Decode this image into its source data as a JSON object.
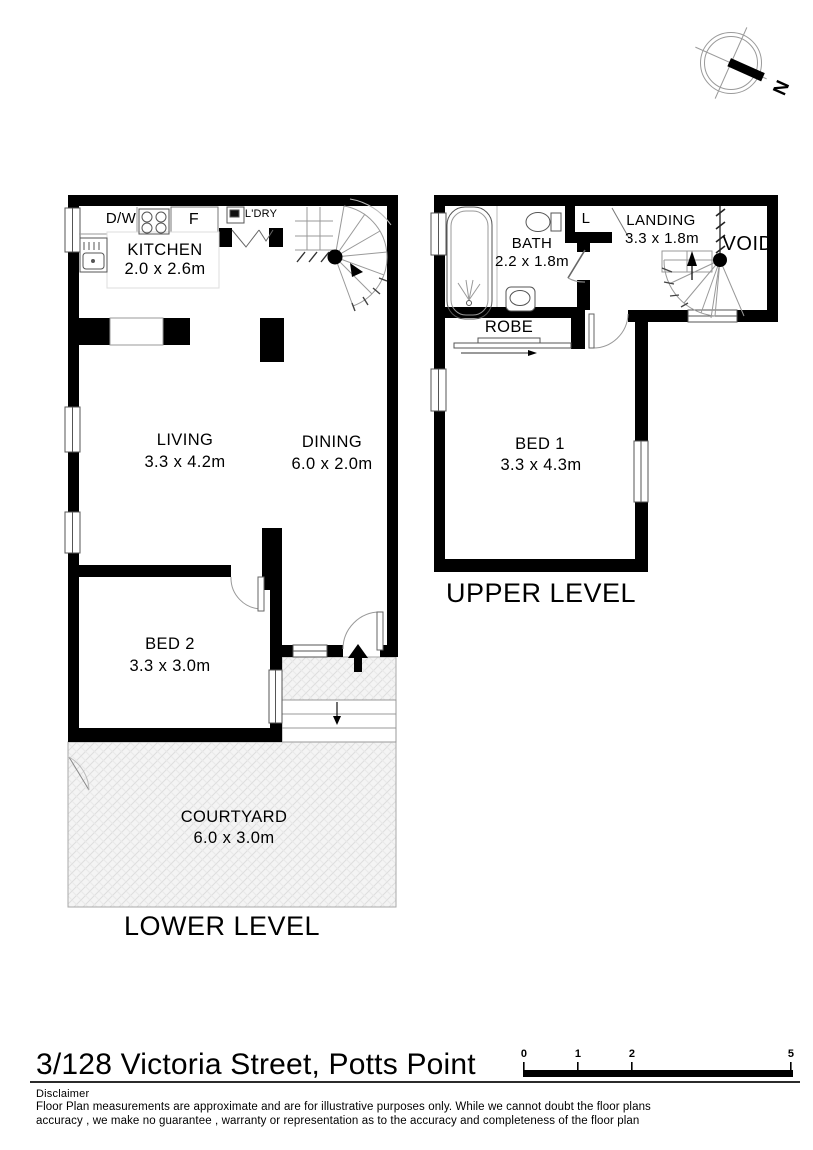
{
  "compass": {
    "north_label": "N"
  },
  "lower": {
    "title": "LOWER LEVEL",
    "rooms": [
      {
        "name": "KITCHEN",
        "dims": "2.0 x 2.6m"
      },
      {
        "name": "LIVING",
        "dims": "3.3 x 4.2m"
      },
      {
        "name": "DINING",
        "dims": "6.0 x 2.0m"
      },
      {
        "name": "BED 2",
        "dims": "3.3 x 3.0m"
      },
      {
        "name": "COURTYARD",
        "dims": "6.0 x 3.0m"
      }
    ],
    "labels": {
      "dishwasher": "D/W",
      "fridge": "F",
      "laundry": "L'DRY"
    }
  },
  "upper": {
    "title": "UPPER LEVEL",
    "rooms": [
      {
        "name": "BATH",
        "dims": "2.2 x 1.8m"
      },
      {
        "name": "LANDING",
        "dims": "3.3 x 1.8m"
      },
      {
        "name": "BED 1",
        "dims": "3.3 x 4.3m"
      }
    ],
    "labels": {
      "linen": "L",
      "void": "VOID",
      "robe": "ROBE"
    }
  },
  "footer": {
    "address": "3/128 Victoria Street, Potts Point",
    "disclaimer_title": "Disclaimer",
    "disclaimer_line1": "Floor Plan measurements are approximate and are for illustrative purposes only. While we cannot doubt the floor plans",
    "disclaimer_line2": "accuracy , we make no guarantee , warranty or representation as to the accuracy and completeness of the floor plan",
    "scale_ticks": [
      "0",
      "1",
      "2",
      "5"
    ]
  },
  "colors": {
    "wall": "#000000",
    "thin_line": "#888888",
    "hatch": "#dedede"
  }
}
